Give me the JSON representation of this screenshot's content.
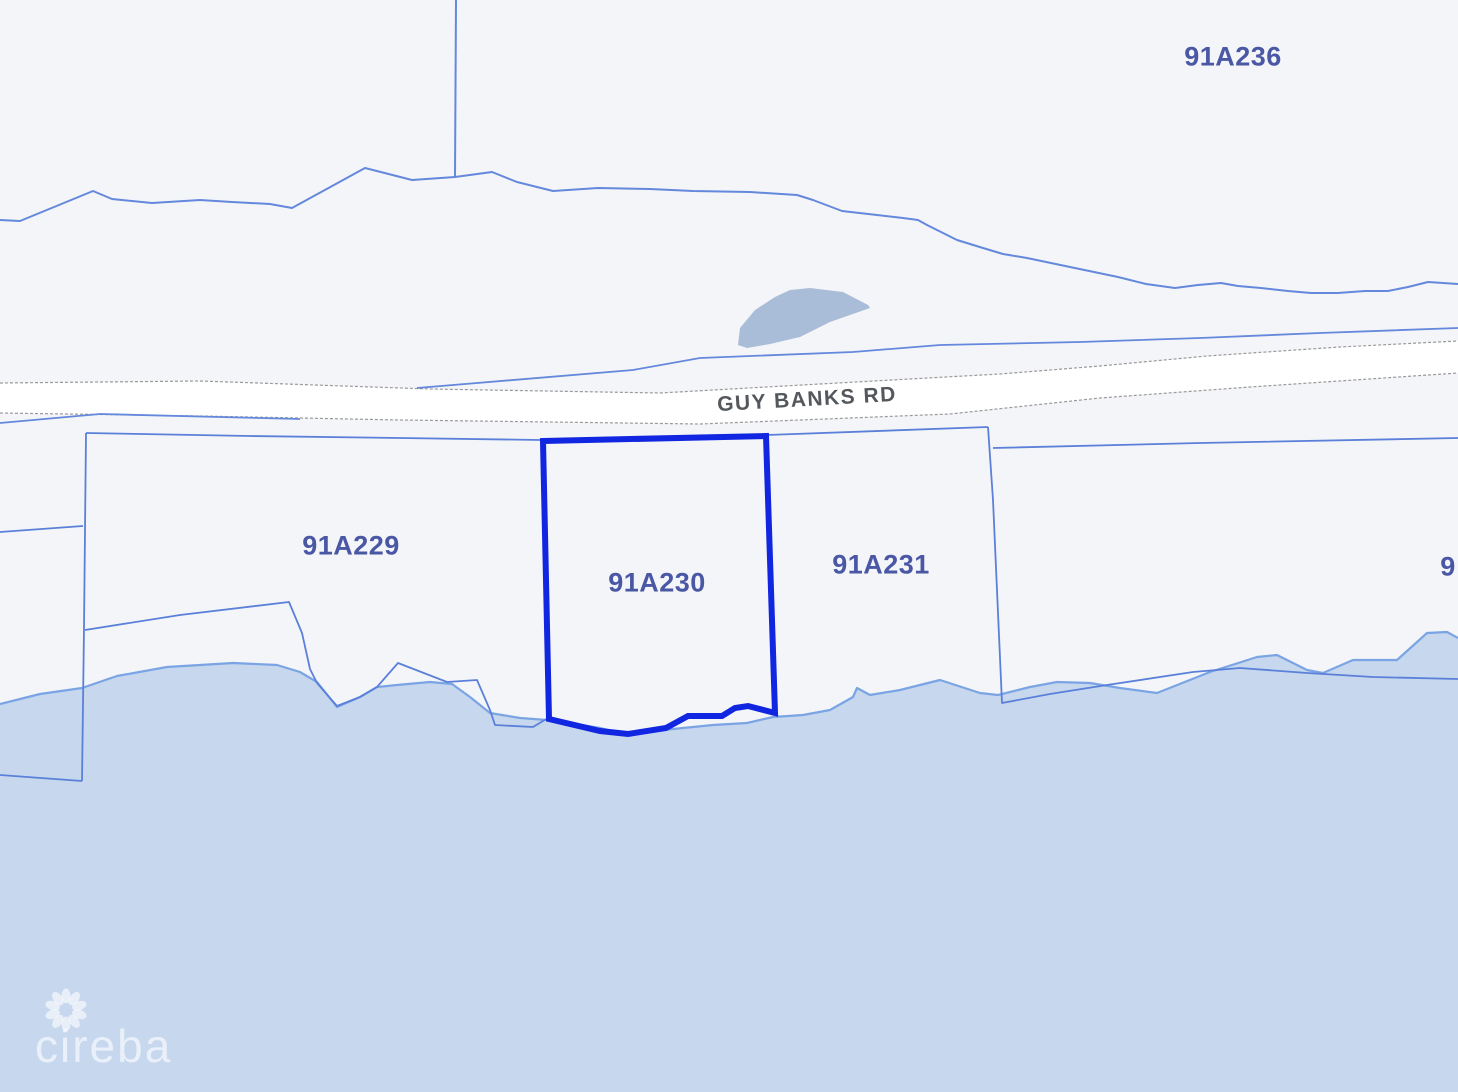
{
  "map": {
    "road": {
      "label": "GUY BANKS RD"
    },
    "parcels": [
      {
        "id": "91A236",
        "highlighted": false
      },
      {
        "id": "91A229",
        "highlighted": false
      },
      {
        "id": "91A230",
        "highlighted": true
      },
      {
        "id": "91A231",
        "highlighted": false
      },
      {
        "id": "9",
        "highlighted": false,
        "partial": true
      }
    ],
    "watermark": "cireba",
    "colors": {
      "land": "#f4f5f8",
      "water_fill": "#c6d7ee",
      "shoreline": "#7aa4e3",
      "pond_fill": "#a9bdd8",
      "parcel_boundary": "#5b80d9",
      "upper_boundary": "#6488dc",
      "highlight_stroke": "#1126e0",
      "road_fill": "#ffffff",
      "road_edge": "#9a9a9a",
      "parcel_label": "#4a57a5",
      "road_label": "#54585c",
      "watermark": "rgba(255,255,255,0.6)"
    }
  }
}
